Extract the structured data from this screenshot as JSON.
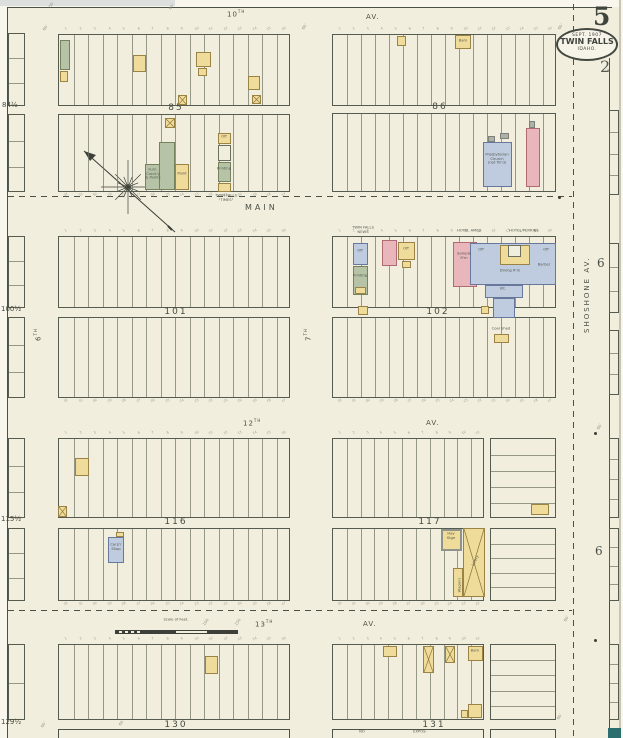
{
  "sheet": {
    "corner": {
      "page_number": "5",
      "page_number_small": "2"
    },
    "stamp": {
      "line1": "SEPT. 1907",
      "line2": "TWIN FALLS",
      "line3": "IDAHO."
    },
    "refs": [
      {
        "t": "6",
        "x": 597,
        "y": 256
      },
      {
        "t": "6",
        "x": 595,
        "y": 544
      }
    ],
    "scale": {
      "label": "Scale of Feet."
    }
  },
  "streets": {
    "h": [
      {
        "num": "10",
        "suf": "TH",
        "x": 227,
        "y": 9
      },
      {
        "text": "AV.",
        "x": 366,
        "y": 13
      },
      {
        "text": "MAIN",
        "x": 245,
        "y": 203,
        "main": 1
      },
      {
        "num": "12",
        "suf": "TH",
        "x": 243,
        "y": 418
      },
      {
        "text": "AV.",
        "x": 426,
        "y": 419
      },
      {
        "num": "13",
        "suf": "TH",
        "x": 255,
        "y": 619
      },
      {
        "text": "AV.",
        "x": 363,
        "y": 620
      }
    ],
    "v": [
      {
        "num": "6",
        "suf": "TH",
        "x": 33,
        "y": 341
      },
      {
        "num": "7",
        "suf": "TH",
        "x": 303,
        "y": 341
      },
      {
        "text": "SHOSHONE  AV.",
        "x": 583,
        "y": 333,
        "sho": 1
      }
    ]
  },
  "lot_numbers": {
    "top16": [
      "1",
      "2",
      "3",
      "4",
      "5",
      "6",
      "7",
      "8",
      "9",
      "10",
      "11",
      "12",
      "13",
      "14",
      "15",
      "16"
    ],
    "bot16": [
      "32",
      "31",
      "30",
      "29",
      "28",
      "27",
      "26",
      "25",
      "24",
      "23",
      "22",
      "21",
      "20",
      "19",
      "18",
      "17"
    ],
    "top11": [
      "1",
      "2",
      "3",
      "4",
      "5",
      "6",
      "7",
      "8",
      "9",
      "10",
      "11"
    ],
    "bot11": [
      "32",
      "31",
      "30",
      "29",
      "28",
      "27",
      "26",
      "25",
      "24",
      "23",
      "22"
    ]
  },
  "blocks": [
    {
      "number": "85",
      "label": {
        "x": 176,
        "y": 103
      },
      "halves": [
        {
          "x": 58,
          "y": 34,
          "w": 232,
          "h": 72,
          "lots": 16,
          "nums": "top16"
        },
        {
          "x": 58,
          "y": 114,
          "w": 232,
          "h": 78,
          "lots": 16,
          "nums": "bot16"
        }
      ]
    },
    {
      "number": "86",
      "label": {
        "x": 440,
        "y": 102
      },
      "halves": [
        {
          "x": 332,
          "y": 34,
          "w": 224,
          "h": 72,
          "lots": 16,
          "nums": "top16"
        },
        {
          "x": 332,
          "y": 113,
          "w": 224,
          "h": 79,
          "lots": 16
        }
      ]
    },
    {
      "number": "101",
      "label": {
        "x": 176,
        "y": 307
      },
      "halves": [
        {
          "x": 58,
          "y": 236,
          "w": 232,
          "h": 72,
          "lots": 16,
          "nums": "top16"
        },
        {
          "x": 58,
          "y": 317,
          "w": 232,
          "h": 81,
          "lots": 16,
          "nums": "bot16"
        }
      ]
    },
    {
      "number": "102",
      "label": {
        "x": 438,
        "y": 307
      },
      "halves": [
        {
          "x": 332,
          "y": 236,
          "w": 224,
          "h": 72,
          "lots": 16,
          "nums": "top16"
        },
        {
          "x": 332,
          "y": 317,
          "w": 224,
          "h": 81,
          "lots": 16,
          "nums": "bot16"
        }
      ]
    },
    {
      "number": "116",
      "label": {
        "x": 176,
        "y": 517
      },
      "halves": [
        {
          "x": 58,
          "y": 438,
          "w": 232,
          "h": 80,
          "lots": 16,
          "nums": "top16"
        },
        {
          "x": 58,
          "y": 528,
          "w": 232,
          "h": 73,
          "lots": 16,
          "nums": "bot16"
        }
      ]
    },
    {
      "number": "117",
      "label": {
        "x": 430,
        "y": 517
      },
      "halves": [
        {
          "x": 332,
          "y": 438,
          "w": 152,
          "h": 80,
          "lots": 11,
          "nums": "top11"
        },
        {
          "x": 332,
          "y": 528,
          "w": 152,
          "h": 73,
          "lots": 11,
          "nums": "bot11"
        },
        {
          "x": 490,
          "y": 438,
          "w": 66,
          "h": 80,
          "rows": 5
        },
        {
          "x": 490,
          "y": 528,
          "w": 66,
          "h": 73,
          "rows": 5
        }
      ]
    },
    {
      "number": "130",
      "label": {
        "x": 176,
        "y": 720
      },
      "halves": [
        {
          "x": 58,
          "y": 644,
          "w": 232,
          "h": 76,
          "lots": 16,
          "nums": "top16"
        }
      ]
    },
    {
      "number": "131",
      "label": {
        "x": 434,
        "y": 720
      },
      "halves": [
        {
          "x": 332,
          "y": 644,
          "w": 152,
          "h": 76,
          "lots": 11,
          "nums": "top11"
        },
        {
          "x": 490,
          "y": 644,
          "w": 66,
          "h": 76,
          "rows": 5
        }
      ]
    }
  ],
  "half_blocks": [
    {
      "label": "84½",
      "lx": 2,
      "ly": 101,
      "parts": [
        {
          "x": 8,
          "y": 33,
          "w": 17,
          "h": 73,
          "rows": 3
        },
        {
          "x": 8,
          "y": 114,
          "w": 17,
          "h": 78,
          "rows": 3
        }
      ]
    },
    {
      "label": "100½",
      "lx": 1,
      "ly": 305,
      "parts": [
        {
          "x": 8,
          "y": 236,
          "w": 17,
          "h": 72,
          "rows": 3
        },
        {
          "x": 8,
          "y": 317,
          "w": 17,
          "h": 81,
          "rows": 3
        }
      ]
    },
    {
      "label": "115½",
      "lx": 1,
      "ly": 515,
      "parts": [
        {
          "x": 8,
          "y": 438,
          "w": 17,
          "h": 80,
          "rows": 3
        },
        {
          "x": 8,
          "y": 528,
          "w": 17,
          "h": 73,
          "rows": 3
        }
      ]
    },
    {
      "label": "129½",
      "lx": 1,
      "ly": 718,
      "parts": [
        {
          "x": 8,
          "y": 644,
          "w": 17,
          "h": 76,
          "rows": 2
        }
      ]
    }
  ],
  "right_strips": [
    {
      "x": 609,
      "y": 110,
      "w": 10,
      "h": 85,
      "rows": 4
    },
    {
      "x": 609,
      "y": 243,
      "w": 10,
      "h": 70,
      "rows": 3
    },
    {
      "x": 609,
      "y": 330,
      "w": 10,
      "h": 65,
      "rows": 3
    },
    {
      "x": 609,
      "y": 438,
      "w": 10,
      "h": 80,
      "rows": 4
    },
    {
      "x": 609,
      "y": 528,
      "w": 10,
      "h": 73,
      "rows": 4
    },
    {
      "x": 609,
      "y": 644,
      "w": 10,
      "h": 76,
      "rows": 4
    }
  ],
  "buildings": [
    {
      "x": 60,
      "y": 40,
      "w": 10,
      "h": 30,
      "c": "g"
    },
    {
      "x": 60,
      "y": 71,
      "w": 8,
      "h": 11,
      "c": "y"
    },
    {
      "x": 133,
      "y": 55,
      "w": 13,
      "h": 17,
      "c": "y"
    },
    {
      "x": 196,
      "y": 52,
      "w": 15,
      "h": 15,
      "c": "y"
    },
    {
      "x": 198,
      "y": 68,
      "w": 9,
      "h": 8,
      "c": "y"
    },
    {
      "x": 178,
      "y": 95,
      "w": 9,
      "h": 10,
      "c": "y",
      "xm": 1
    },
    {
      "x": 248,
      "y": 76,
      "w": 12,
      "h": 14,
      "c": "y"
    },
    {
      "x": 252,
      "y": 95,
      "w": 9,
      "h": 9,
      "c": "y",
      "xm": 1
    },
    {
      "x": 165,
      "y": 118,
      "w": 10,
      "h": 10,
      "c": "y",
      "xm": 1
    },
    {
      "x": 159,
      "y": 142,
      "w": 16,
      "h": 48,
      "c": "g"
    },
    {
      "x": 145,
      "y": 164,
      "w": 15,
      "h": 26,
      "c": "g"
    },
    {
      "x": 175,
      "y": 164,
      "w": 14,
      "h": 26,
      "c": "y"
    },
    {
      "x": 218,
      "y": 133,
      "w": 13,
      "h": 11,
      "c": "y"
    },
    {
      "x": 218,
      "y": 145,
      "w": 13,
      "h": 16,
      "c": "w"
    },
    {
      "x": 218,
      "y": 162,
      "w": 13,
      "h": 20,
      "c": "g"
    },
    {
      "x": 218,
      "y": 183,
      "w": 13,
      "h": 9,
      "c": "y"
    },
    {
      "x": 397,
      "y": 36,
      "w": 9,
      "h": 10,
      "c": "y"
    },
    {
      "x": 455,
      "y": 35,
      "w": 16,
      "h": 14,
      "c": "y"
    },
    {
      "x": 483,
      "y": 142,
      "w": 29,
      "h": 45,
      "c": "b"
    },
    {
      "x": 488,
      "y": 136,
      "w": 7,
      "h": 6,
      "c": "gr"
    },
    {
      "x": 500,
      "y": 133,
      "w": 9,
      "h": 6,
      "c": "gr"
    },
    {
      "x": 526,
      "y": 128,
      "w": 14,
      "h": 59,
      "c": "p"
    },
    {
      "x": 529,
      "y": 121,
      "w": 6,
      "h": 7,
      "c": "gr"
    },
    {
      "x": 353,
      "y": 243,
      "w": 15,
      "h": 22,
      "c": "b"
    },
    {
      "x": 353,
      "y": 266,
      "w": 15,
      "h": 29,
      "c": "g"
    },
    {
      "x": 355,
      "y": 287,
      "w": 11,
      "h": 7,
      "c": "y"
    },
    {
      "x": 358,
      "y": 306,
      "w": 10,
      "h": 9,
      "c": "y"
    },
    {
      "x": 382,
      "y": 240,
      "w": 15,
      "h": 26,
      "c": "p"
    },
    {
      "x": 398,
      "y": 242,
      "w": 17,
      "h": 18,
      "c": "y"
    },
    {
      "x": 402,
      "y": 261,
      "w": 9,
      "h": 7,
      "c": "y"
    },
    {
      "x": 453,
      "y": 242,
      "w": 24,
      "h": 45,
      "c": "p"
    },
    {
      "x": 470,
      "y": 243,
      "w": 86,
      "h": 42,
      "c": "b"
    },
    {
      "x": 500,
      "y": 245,
      "w": 30,
      "h": 20,
      "c": "y"
    },
    {
      "x": 508,
      "y": 245,
      "w": 13,
      "h": 12,
      "c": "w"
    },
    {
      "x": 485,
      "y": 285,
      "w": 38,
      "h": 13,
      "c": "b"
    },
    {
      "x": 493,
      "y": 298,
      "w": 22,
      "h": 20,
      "c": "b"
    },
    {
      "x": 481,
      "y": 306,
      "w": 8,
      "h": 8,
      "c": "y"
    },
    {
      "x": 494,
      "y": 334,
      "w": 15,
      "h": 9,
      "c": "y"
    },
    {
      "x": 75,
      "y": 458,
      "w": 14,
      "h": 18,
      "c": "y"
    },
    {
      "x": 58,
      "y": 506,
      "w": 9,
      "h": 11,
      "c": "y",
      "xm": 1
    },
    {
      "x": 108,
      "y": 537,
      "w": 16,
      "h": 26,
      "c": "b"
    },
    {
      "x": 116,
      "y": 532,
      "w": 8,
      "h": 5,
      "c": "y"
    },
    {
      "x": 531,
      "y": 504,
      "w": 18,
      "h": 11,
      "c": "y"
    },
    {
      "x": 441,
      "y": 529,
      "w": 21,
      "h": 22,
      "c": "y",
      "fr": 1
    },
    {
      "x": 463,
      "y": 528,
      "w": 22,
      "h": 69,
      "c": "y",
      "xm": 1
    },
    {
      "x": 453,
      "y": 568,
      "w": 10,
      "h": 29,
      "c": "y"
    },
    {
      "x": 205,
      "y": 656,
      "w": 13,
      "h": 18,
      "c": "y"
    },
    {
      "x": 383,
      "y": 646,
      "w": 14,
      "h": 11,
      "c": "y"
    },
    {
      "x": 423,
      "y": 646,
      "w": 11,
      "h": 27,
      "c": "y",
      "xm": 1
    },
    {
      "x": 445,
      "y": 646,
      "w": 10,
      "h": 17,
      "c": "y",
      "xm": 1
    },
    {
      "x": 468,
      "y": 646,
      "w": 15,
      "h": 15,
      "c": "y"
    },
    {
      "x": 468,
      "y": 704,
      "w": 14,
      "h": 14,
      "c": "y"
    },
    {
      "x": 461,
      "y": 710,
      "w": 7,
      "h": 8,
      "c": "y"
    }
  ],
  "tiny_labels": [
    {
      "x": 153,
      "y": 168,
      "lines": [
        "Furn.",
        "Crock'y",
        "& Paints"
      ]
    },
    {
      "x": 182,
      "y": 172,
      "lines": [
        "Paint"
      ]
    },
    {
      "x": 224,
      "y": 135,
      "lines": [
        "Off"
      ]
    },
    {
      "x": 224,
      "y": 167,
      "lines": [
        "Printing"
      ]
    },
    {
      "x": 226,
      "y": 194,
      "lines": [
        "TWIN FALLS",
        "\"TIMES\""
      ]
    },
    {
      "x": 463,
      "y": 39,
      "lines": [
        "Barn"
      ]
    },
    {
      "x": 497,
      "y": 153,
      "lines": [
        "Presbyterian",
        "Church",
        "(not fin'd)"
      ]
    },
    {
      "x": 363,
      "y": 226,
      "lines": [
        "TWIN FALLS",
        "NEWS"
      ]
    },
    {
      "x": 360,
      "y": 249,
      "lines": [
        "Off"
      ]
    },
    {
      "x": 360,
      "y": 274,
      "lines": [
        "Printing"
      ]
    },
    {
      "x": 406,
      "y": 247,
      "lines": [
        "Off"
      ]
    },
    {
      "x": 469,
      "y": 229,
      "lines": [
        "HOTEL  AMES"
      ]
    },
    {
      "x": 524,
      "y": 229,
      "lines": [
        "HOTEL  PERRINE"
      ]
    },
    {
      "x": 464,
      "y": 252,
      "lines": [
        "Sample",
        "R'm"
      ]
    },
    {
      "x": 481,
      "y": 248,
      "lines": [
        "Off"
      ]
    },
    {
      "x": 546,
      "y": 248,
      "lines": [
        "Off"
      ]
    },
    {
      "x": 510,
      "y": 269,
      "lines": [
        "Dining R'm"
      ]
    },
    {
      "x": 544,
      "y": 263,
      "lines": [
        "Barber"
      ]
    },
    {
      "x": 503,
      "y": 287,
      "lines": [
        "Kit."
      ]
    },
    {
      "x": 501,
      "y": 327,
      "lines": [
        "Coal Shed"
      ]
    },
    {
      "x": 451,
      "y": 532,
      "lines": [
        "Hay",
        "Stge"
      ]
    },
    {
      "x": 458,
      "y": 585,
      "rot": -90,
      "lines": [
        "Wagons"
      ]
    },
    {
      "x": 474,
      "y": 560,
      "rot": -63,
      "lines": [
        "Livery"
      ]
    },
    {
      "x": 116,
      "y": 543,
      "lines": [
        "Carp'r",
        "Shop"
      ]
    },
    {
      "x": 475,
      "y": 649,
      "lines": [
        "Barn"
      ]
    },
    {
      "x": 362,
      "y": 730,
      "lines": [
        "NO"
      ]
    },
    {
      "x": 420,
      "y": 730,
      "lines": [
        "EXPOS-"
      ]
    }
  ],
  "ticks": [
    {
      "t": "50'",
      "x": 48,
      "y": 6
    },
    {
      "t": "60'",
      "x": 168,
      "y": 8
    },
    {
      "t": "60'",
      "x": 42,
      "y": 29
    },
    {
      "t": "60'",
      "x": 301,
      "y": 28
    },
    {
      "t": "60'",
      "x": 557,
      "y": 28
    },
    {
      "t": "60'",
      "x": 40,
      "y": 726
    },
    {
      "t": "60'",
      "x": 118,
      "y": 724
    },
    {
      "t": "60'",
      "x": 563,
      "y": 620
    },
    {
      "t": "60'",
      "x": 556,
      "y": 718
    },
    {
      "t": "60'",
      "x": 596,
      "y": 428
    },
    {
      "t": "100",
      "x": 202,
      "y": 624
    },
    {
      "t": "150",
      "x": 234,
      "y": 624
    }
  ],
  "dots": [
    {
      "x": 558,
      "y": 196
    },
    {
      "x": 594,
      "y": 432
    },
    {
      "x": 594,
      "y": 639
    }
  ]
}
